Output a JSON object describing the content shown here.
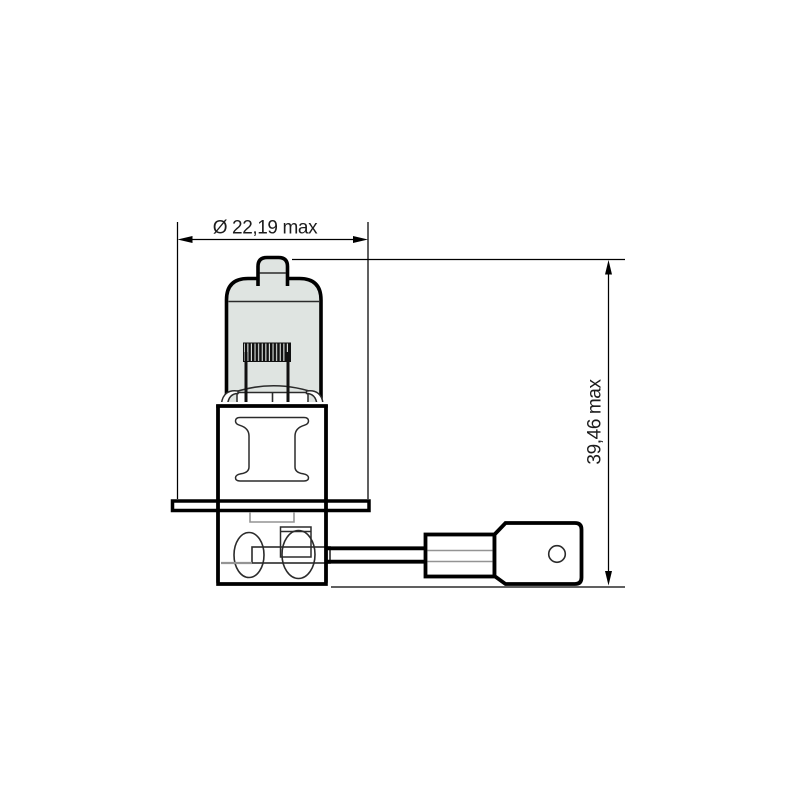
{
  "labels": {
    "diameter": "Ø 22,19 max",
    "height": "39,46 max"
  },
  "colors": {
    "background": "#ffffff",
    "outline": "#000000",
    "thin": "#2b2b2b",
    "gray": "#949494",
    "glass": "#dfe4e1",
    "text": "#1c1c1c"
  }
}
